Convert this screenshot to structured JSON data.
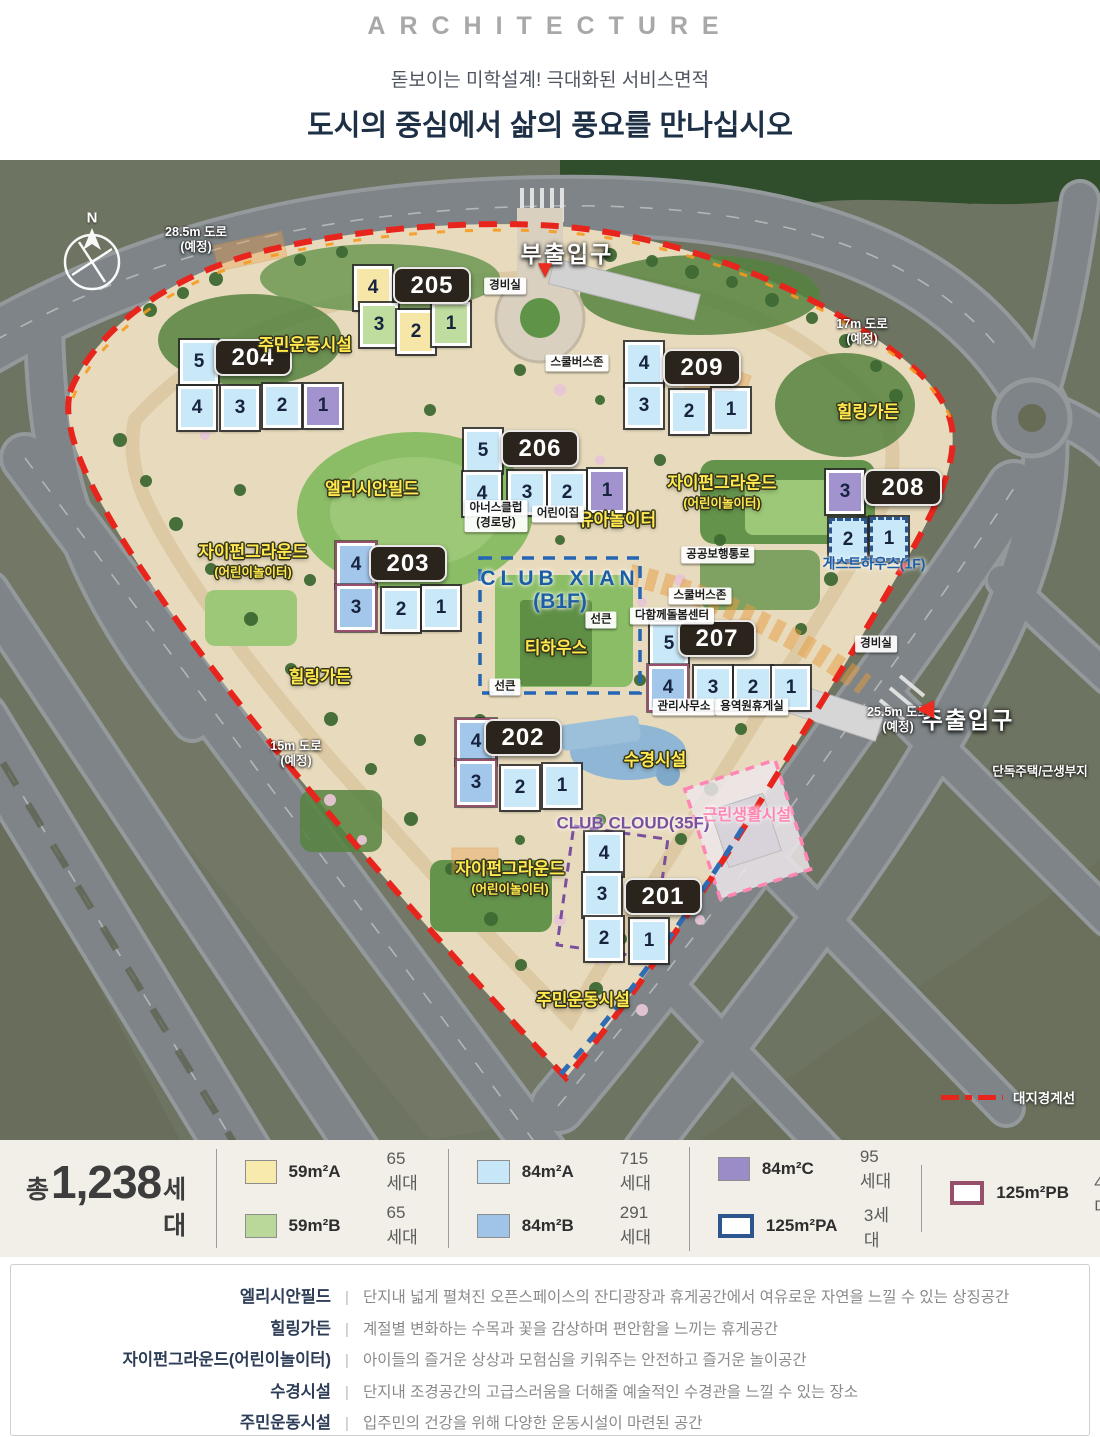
{
  "header": {
    "eyebrow": "ARCHITECTURE",
    "subtitle": "돋보이는 미학설계! 극대화된 서비스면적",
    "title": "도시의 중심에서 삶의 풍요를 만나십시오"
  },
  "map": {
    "compass_label": "N",
    "unit_fills": {
      "59A": "#f6e6a8",
      "59B": "#bedd9e",
      "84A": "#c9e8f8",
      "84B": "#a3c7eb",
      "84C": "#a293ce"
    },
    "buildings": [
      {
        "number": "205",
        "badge": [
          430,
          124
        ],
        "units": [
          {
            "n": "4",
            "t": "59A",
            "x": 373,
            "y": 128
          },
          {
            "n": "3",
            "t": "59B",
            "x": 379,
            "y": 165
          },
          {
            "n": "2",
            "t": "59A",
            "x": 416,
            "y": 172
          },
          {
            "n": "1",
            "t": "59B",
            "x": 451,
            "y": 164
          }
        ]
      },
      {
        "number": "204",
        "badge": [
          251,
          196
        ],
        "units": [
          {
            "n": "5",
            "t": "84A",
            "x": 199,
            "y": 202
          },
          {
            "n": "4",
            "t": "84A",
            "x": 197,
            "y": 248
          },
          {
            "n": "3",
            "t": "84A",
            "x": 240,
            "y": 248
          },
          {
            "n": "2",
            "t": "84A",
            "x": 282,
            "y": 246
          },
          {
            "n": "1",
            "t": "84C",
            "x": 323,
            "y": 246
          }
        ]
      },
      {
        "number": "209",
        "badge": [
          700,
          206
        ],
        "units": [
          {
            "n": "4",
            "t": "84A",
            "x": 644,
            "y": 204
          },
          {
            "n": "3",
            "t": "84A",
            "x": 644,
            "y": 246
          },
          {
            "n": "2",
            "t": "84A",
            "x": 689,
            "y": 252
          },
          {
            "n": "1",
            "t": "84A",
            "x": 731,
            "y": 250
          }
        ]
      },
      {
        "number": "206",
        "badge": [
          538,
          287
        ],
        "units": [
          {
            "n": "5",
            "t": "84A",
            "x": 483,
            "y": 291
          },
          {
            "n": "4",
            "t": "84A",
            "x": 482,
            "y": 334
          },
          {
            "n": "3",
            "t": "84A",
            "x": 527,
            "y": 333
          },
          {
            "n": "2",
            "t": "84A",
            "x": 567,
            "y": 333
          },
          {
            "n": "1",
            "t": "84C",
            "x": 607,
            "y": 331
          }
        ]
      },
      {
        "number": "208",
        "badge": [
          901,
          326
        ],
        "units": [
          {
            "n": "3",
            "t": "84C",
            "x": 845,
            "y": 332
          },
          {
            "n": "2",
            "t": "84A",
            "o": "PA",
            "x": 848,
            "y": 380
          },
          {
            "n": "1",
            "t": "84A",
            "o": "PA",
            "x": 889,
            "y": 379
          }
        ]
      },
      {
        "number": "203",
        "badge": [
          406,
          402
        ],
        "units": [
          {
            "n": "4",
            "t": "84B",
            "o": "PB",
            "x": 356,
            "y": 405
          },
          {
            "n": "3",
            "t": "84B",
            "o": "PB",
            "x": 356,
            "y": 448
          },
          {
            "n": "2",
            "t": "84A",
            "x": 401,
            "y": 450
          },
          {
            "n": "1",
            "t": "84A",
            "x": 441,
            "y": 448
          }
        ]
      },
      {
        "number": "207",
        "badge": [
          715,
          477
        ],
        "units": [
          {
            "n": "5",
            "t": "84A",
            "x": 669,
            "y": 484
          },
          {
            "n": "4",
            "t": "84B",
            "o": "PB",
            "x": 668,
            "y": 528
          },
          {
            "n": "3",
            "t": "84A",
            "x": 713,
            "y": 528
          },
          {
            "n": "2",
            "t": "84A",
            "x": 753,
            "y": 528
          },
          {
            "n": "1",
            "t": "84A",
            "x": 791,
            "y": 528
          }
        ]
      },
      {
        "number": "202",
        "badge": [
          521,
          576
        ],
        "units": [
          {
            "n": "4",
            "t": "84B",
            "o": "PB",
            "x": 476,
            "y": 582
          },
          {
            "n": "3",
            "t": "84B",
            "o": "PB",
            "x": 476,
            "y": 623
          },
          {
            "n": "2",
            "t": "84A",
            "x": 520,
            "y": 628
          },
          {
            "n": "1",
            "t": "84A",
            "x": 562,
            "y": 626
          }
        ]
      },
      {
        "number": "201",
        "badge": [
          661,
          735
        ],
        "units": [
          {
            "n": "4",
            "t": "84A",
            "x": 604,
            "y": 694
          },
          {
            "n": "3",
            "t": "84A",
            "x": 602,
            "y": 735
          },
          {
            "n": "2",
            "t": "84A",
            "x": 604,
            "y": 779
          },
          {
            "n": "1",
            "t": "84A",
            "x": 649,
            "y": 781
          }
        ]
      }
    ],
    "facility_labels": [
      {
        "lines": [
          "주민운동시설"
        ],
        "x": 305,
        "y": 183
      },
      {
        "lines": [
          "엘리시안필드"
        ],
        "x": 372,
        "y": 327
      },
      {
        "lines": [
          "자이펀그라운드",
          "(어린이놀이터)"
        ],
        "x": 253,
        "y": 399
      },
      {
        "lines": [
          "자이펀그라운드",
          "(어린이놀이터)"
        ],
        "x": 722,
        "y": 330
      },
      {
        "lines": [
          "자이펀그라운드",
          "(어린이놀이터)"
        ],
        "x": 510,
        "y": 716
      },
      {
        "lines": [
          "힐링가든"
        ],
        "x": 868,
        "y": 250
      },
      {
        "lines": [
          "힐링가든"
        ],
        "x": 320,
        "y": 515
      },
      {
        "lines": [
          "유아놀이터"
        ],
        "x": 617,
        "y": 358
      },
      {
        "lines": [
          "티하우스"
        ],
        "x": 556,
        "y": 486
      },
      {
        "lines": [
          "수경시설"
        ],
        "x": 655,
        "y": 598
      },
      {
        "lines": [
          "주민운동시설"
        ],
        "x": 583,
        "y": 838
      }
    ],
    "special_labels": [
      {
        "lines": [
          "CLUB XIAN",
          "(B1F)"
        ],
        "x": 560,
        "y": 430,
        "color": "#1b5ea6",
        "size": 21,
        "spaced": true
      },
      {
        "lines": [
          "CLUB CLOUD(35F)"
        ],
        "x": 633,
        "y": 664,
        "color": "#7a4f9e",
        "size": 17
      },
      {
        "lines": [
          "근린생활시설"
        ],
        "x": 747,
        "y": 656,
        "color": "#ff85b3",
        "size": 16
      },
      {
        "lines": [
          "게스트하우스(1F)"
        ],
        "x": 874,
        "y": 404,
        "color": "#1b5ea6",
        "size": 14
      }
    ],
    "chip_labels": [
      {
        "lines": [
          "경비실"
        ],
        "x": 505,
        "y": 126
      },
      {
        "lines": [
          "스쿨버스존"
        ],
        "x": 577,
        "y": 203
      },
      {
        "lines": [
          "아너스클럽",
          "(경로당)"
        ],
        "x": 496,
        "y": 356
      },
      {
        "lines": [
          "어린이집"
        ],
        "x": 558,
        "y": 354
      },
      {
        "lines": [
          "공공보행통로"
        ],
        "x": 718,
        "y": 395
      },
      {
        "lines": [
          "스쿨버스존"
        ],
        "x": 700,
        "y": 436
      },
      {
        "lines": [
          "다함께돌봄센터"
        ],
        "x": 672,
        "y": 456
      },
      {
        "lines": [
          "선큰"
        ],
        "x": 601,
        "y": 460
      },
      {
        "lines": [
          "선큰"
        ],
        "x": 505,
        "y": 527
      },
      {
        "lines": [
          "관리사무소"
        ],
        "x": 684,
        "y": 547
      },
      {
        "lines": [
          "용역원휴게실"
        ],
        "x": 752,
        "y": 547
      },
      {
        "lines": [
          "경비실"
        ],
        "x": 876,
        "y": 484
      }
    ],
    "road_labels": [
      {
        "lines": [
          "28.5m 도로",
          "(예정)"
        ],
        "x": 196,
        "y": 80
      },
      {
        "lines": [
          "17m 도로",
          "(예정)"
        ],
        "x": 862,
        "y": 172
      },
      {
        "lines": [
          "15m 도로",
          "(예정)"
        ],
        "x": 296,
        "y": 594
      },
      {
        "lines": [
          "25.5m 도로",
          "(예정)"
        ],
        "x": 898,
        "y": 560
      },
      {
        "lines": [
          "단독주택/근생부지"
        ],
        "x": 1040,
        "y": 612
      }
    ],
    "entrances": [
      {
        "label": "부출입구",
        "x": 567,
        "y": 92,
        "marker": "▼",
        "mx": 545,
        "my": 110
      },
      {
        "label": "주출입구",
        "x": 968,
        "y": 558,
        "marker": "◀",
        "mx": 925,
        "my": 548
      }
    ],
    "boundary_legend": {
      "label": "대지경계선",
      "x": 1008,
      "y": 937
    }
  },
  "legend": {
    "total_prefix": "총",
    "total_value": "1,238",
    "total_suffix": "세대",
    "swatch_colors": {
      "59A": "#f8e9ad",
      "59B": "#b9d899",
      "84A": "#c7e6f8",
      "84B": "#a0c4e8",
      "84C": "#9b8cc8",
      "125PA": "#ffffff",
      "125PB": "#ffffff"
    },
    "swatch_borders": {
      "125PA": "#2d5590",
      "125PB": "#96506b"
    },
    "groups": [
      [
        {
          "type": "59A",
          "label": "59m²A",
          "count": "65세대"
        },
        {
          "type": "59B",
          "label": "59m²B",
          "count": "65세대"
        }
      ],
      [
        {
          "type": "84A",
          "label": "84m²A",
          "count": "715세대"
        },
        {
          "type": "84B",
          "label": "84m²B",
          "count": "291세대"
        }
      ],
      [
        {
          "type": "84C",
          "label": "84m²C",
          "count": "95세대"
        },
        {
          "type": "125PA",
          "label": "125m²PA",
          "count": "3세대"
        }
      ],
      [
        {
          "type": "125PB",
          "label": "125m²PB",
          "count": "4세대"
        }
      ]
    ]
  },
  "descriptions": [
    {
      "term": "엘리시안필드",
      "text": "단지내 넓게 펼쳐진 오픈스페이스의 잔디광장과 휴게공간에서 여유로운 자연을 느낄 수 있는 상징공간"
    },
    {
      "term": "힐링가든",
      "text": "계절별 변화하는 수목과 꽃을 감상하며 편안함을 느끼는 휴게공간"
    },
    {
      "term": "자이펀그라운드(어린이놀이터)",
      "text": "아이들의 즐거운 상상과 모험심을 키워주는 안전하고 즐거운 놀이공간"
    },
    {
      "term": "수경시설",
      "text": "단지내 조경공간의 고급스러움을 더해줄 예술적인 수경관을 느낄 수 있는 장소"
    },
    {
      "term": "주민운동시설",
      "text": "입주민의 건강을 위해 다양한 운동시설이 마련된 공간"
    }
  ]
}
